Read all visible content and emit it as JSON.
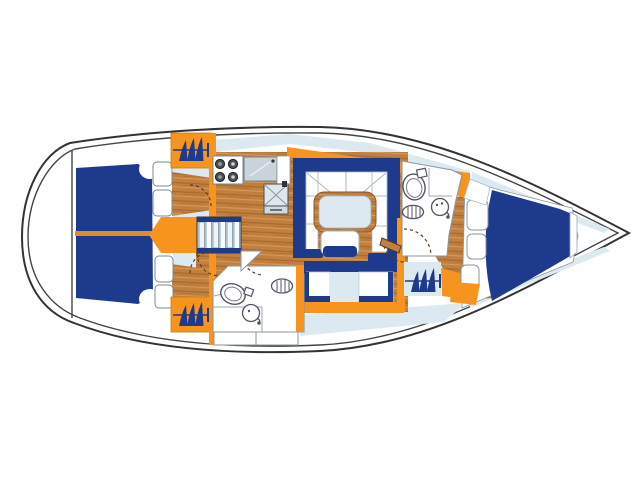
{
  "diagram": {
    "title": "Sailboat interior layout floor plan",
    "view": "top-down deck plan, bow pointing right, stern at left",
    "text_visible_on_screen": "none",
    "colors": {
      "background": "#ffffff",
      "hull_outline": "#333333",
      "upholstery_navy": "#1e3a8c",
      "joinery_orange": "#f7941e",
      "wood_sole": "#c2803f",
      "wood_grain_dark": "#a5662a",
      "wood_grain_light": "#d59a5f",
      "deck_gray_blue": "#dde9f1",
      "counter_gray": "#c9d3da",
      "furniture_outline": "#7a8894"
    },
    "areas": [
      {
        "name": "swim-platform",
        "desc": "white transom area at stern (far left)"
      },
      {
        "name": "cockpit",
        "desc": "navy bench cushions with orange centre table line and four white helm cushions"
      },
      {
        "name": "companionway",
        "desc": "orange entry hatch arrow and six-tread ladder with navy edges"
      },
      {
        "name": "aft-cabin-port",
        "desc": "berth stowage symbol (navy sail glyphs on orange) with wood cabin sole"
      },
      {
        "name": "aft-cabin-starboard",
        "desc": "berth stowage symbol (navy sail glyphs on orange) with wood cabin sole"
      },
      {
        "name": "galley",
        "desc": "four-burner stove, gray sink counter, icebox with X lid"
      },
      {
        "name": "salon",
        "desc": "U-shaped settee with navy trim, wood table with pale top, centre stool, straight starboard settee"
      },
      {
        "name": "aft-head",
        "desc": "toilet, round sink with faucet, louvered vent, lockers below"
      },
      {
        "name": "stowage-starboard",
        "desc": "sail-glyph stowage symbol beside nav area with orange trim"
      },
      {
        "name": "forward-head",
        "desc": "toilet, round sink, louvered vent beside wood passage"
      },
      {
        "name": "forward-cabin",
        "desc": "large navy V-berth with white surround, three side shelves, orange trim"
      },
      {
        "name": "door-swings",
        "desc": "dashed quarter-circle arcs at cabin and head doors"
      }
    ],
    "symbol_legend": {
      "sail-glyph": "three navy curved triangles crossed by a line with end tick, repeated 3 times",
      "louvered-vent": "oval with vertical slats",
      "burners": "4 dark circles on white stove top"
    }
  }
}
